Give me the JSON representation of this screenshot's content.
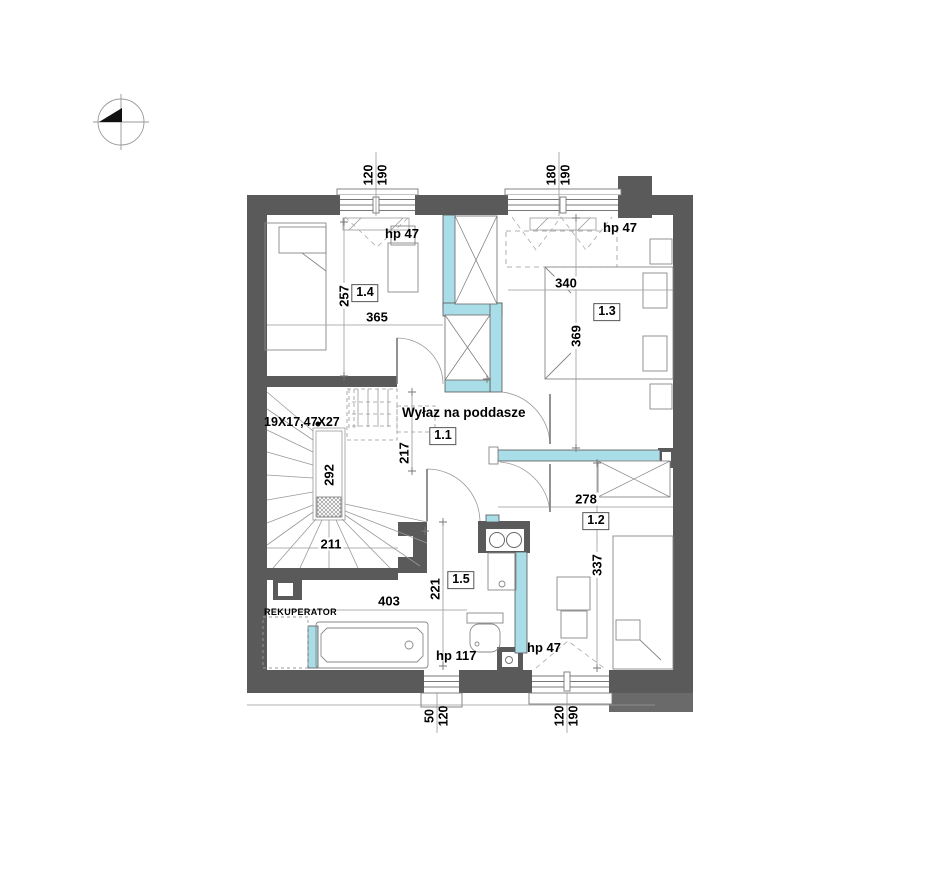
{
  "plan": {
    "attic_hatch_note": "Wyłaz na poddasze",
    "stairs_spec": "19X17,47X27",
    "rekuperator": "REKUPERATOR",
    "rooms": {
      "hall": "1.1",
      "bedroom_se": "1.2",
      "bedroom_ne": "1.3",
      "bedroom_nw": "1.4",
      "bathroom": "1.5"
    },
    "window_sill_labels": {
      "top_left": "hp 47",
      "top_right": "hp 47",
      "bottom_middle": "hp 117",
      "bottom_right": "hp 47"
    },
    "window_dims": {
      "top_left": {
        "w": "120",
        "h": "190"
      },
      "top_right": {
        "w": "180",
        "h": "190"
      },
      "bottom_middle": {
        "w": "50",
        "h": "120"
      },
      "bottom_right": {
        "w": "120",
        "h": "190"
      }
    },
    "room_dims": {
      "d_14_h": "257",
      "d_14_w": "365",
      "d_13_w": "340",
      "d_13_h": "369",
      "d_hall": "217",
      "d_stair_flight": "292",
      "d_stair_w": "211",
      "d_12_w": "278",
      "d_12_h": "337",
      "d_bath_w": "403",
      "d_bath_h": "221"
    },
    "colors": {
      "wall": "#5a5a5a",
      "partition": "#a9dde8"
    }
  }
}
